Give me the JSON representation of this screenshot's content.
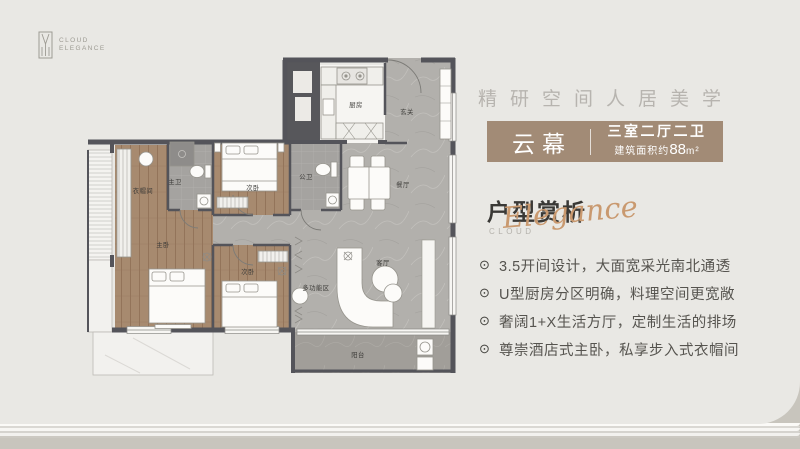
{
  "brand": {
    "line1": "CLOUD",
    "line2": "ELEGANCE"
  },
  "header": {
    "tagline": "精研空间人居美学"
  },
  "badge": {
    "name": "云幕",
    "spec": "三室二厅二卫",
    "area_prefix": "建筑面积约",
    "area_value": "88",
    "area_unit": "m²"
  },
  "section": {
    "title": "户型赏析",
    "subtitle_small": "CLOUD",
    "subtitle_script": "Elegance"
  },
  "features_bullet_icon": "⊙",
  "features": [
    "3.5开间设计，大面宽采光南北通透",
    "U型厨房分区明确，料理空间更宽敞",
    "奢阔1+X生活方厅，定制生活的排场",
    "尊崇酒店式主卧，私享步入式衣帽间"
  ],
  "floor_plan": {
    "rooms": [
      {
        "label": "厨房",
        "x": 271,
        "y": 52
      },
      {
        "label": "玄关",
        "x": 322,
        "y": 59
      },
      {
        "label": "衣帽间",
        "x": 58,
        "y": 138
      },
      {
        "label": "主卫",
        "x": 90,
        "y": 129
      },
      {
        "label": "次卧",
        "x": 168,
        "y": 135
      },
      {
        "label": "公卫",
        "x": 221,
        "y": 124
      },
      {
        "label": "餐厅",
        "x": 318,
        "y": 132
      },
      {
        "label": "主卧",
        "x": 78,
        "y": 192
      },
      {
        "label": "次卧",
        "x": 163,
        "y": 219
      },
      {
        "label": "多功能区",
        "x": 231,
        "y": 235
      },
      {
        "label": "客厅",
        "x": 298,
        "y": 210
      },
      {
        "label": "阳台",
        "x": 273,
        "y": 302
      }
    ]
  },
  "colors": {
    "background": "#e9e8e4",
    "badge_bg": "#a28b76",
    "accent_copper": "#c9996f",
    "wall": "#54545a",
    "wood_floor": "#a78a6f",
    "stone_floor": "#b2b0ac",
    "balcony_floor": "#a19e99",
    "bottom_band": "#c8c5bd"
  }
}
